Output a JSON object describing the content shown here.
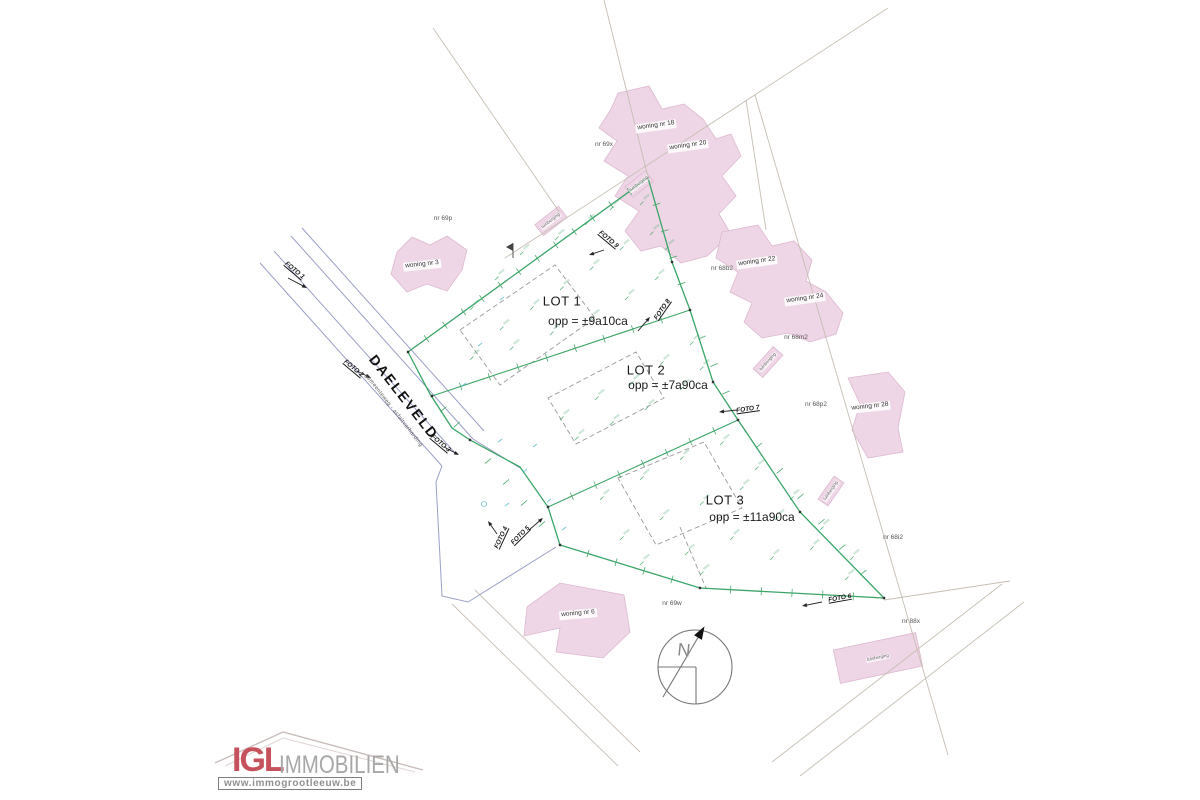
{
  "plan": {
    "street": {
      "name": "DAELEVELD",
      "type_label": "gemeenteweg - asfaltverharding"
    },
    "lots": [
      {
        "name": "LOT 1",
        "area": "opp = ±9a10ca"
      },
      {
        "name": "LOT 2",
        "area": "opp = ±7a90ca"
      },
      {
        "name": "LOT 3",
        "area": "opp = ±11a90ca"
      }
    ],
    "houses": [
      "woning nr 3",
      "woning nr 18",
      "woning nr 20",
      "woning nr 22",
      "woning nr 24",
      "woning nr 28",
      "woning nr 6"
    ],
    "outbuilding_label": "tuinberging",
    "parcels": [
      "nr 69p",
      "nr 69x",
      "nr 68b2",
      "nr 68m2",
      "nr 68p2",
      "nr 68i2",
      "nr 88x",
      "nr 69w"
    ],
    "photo_markers": [
      "FOTO 1",
      "FOTO 2",
      "FOTO 3",
      "FOTO 4",
      "FOTO 5",
      "FOTO 6",
      "FOTO 7",
      "FOTO 8",
      "FOTO 9"
    ],
    "compass_label": "N"
  },
  "logo": {
    "initials": "IGL",
    "word": "IMMOBILIEN",
    "website": "www.immogrootleeuw.be"
  },
  "colors": {
    "lot_boundary_green": "#3aa567",
    "building_pink": "#eed6e6",
    "road_blue": "#9aa0c8",
    "parcel_line_gray": "#c6beb2",
    "survey_mark_green": "#4aa96e",
    "utility_cyan": "#49b9c9",
    "logo_red": "#c5525c",
    "logo_gray": "#a7a7a7"
  }
}
